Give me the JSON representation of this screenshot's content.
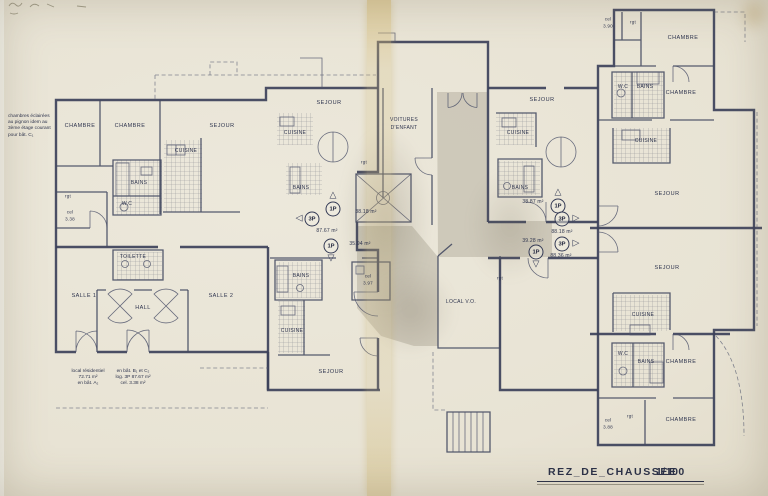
{
  "title": {
    "name": "REZ_DE_CHAUSSEE",
    "scale": "1/100"
  },
  "labels": {
    "chambre": "CHAMBRE",
    "sejour": "SEJOUR",
    "cuisine": "CUISINE",
    "bains": "BAINS",
    "wc": "W.C",
    "toilette": "TOILETTE",
    "salle1": "SALLE 1",
    "salle2": "SALLE 2",
    "hall": "HALL",
    "voitures1": "VOITURES",
    "voitures2": "D'ENFANT",
    "local_vo": "LOCAL V.O.",
    "rgt": "rgt",
    "cel": "cel"
  },
  "cells": {
    "left": "3.38",
    "center": "3.97",
    "top_right": "3.90",
    "bottom_right": "3.88"
  },
  "arrows": {
    "up": "△",
    "down": "▽",
    "left": "◁",
    "right": "▷"
  },
  "units": [
    {
      "type": "1P",
      "area": "38.18 m²"
    },
    {
      "type": "3P",
      "area": "87.67 m²"
    },
    {
      "type": "1P",
      "area": "35.94 m²"
    },
    {
      "type": "1P",
      "area": "38.87 m²"
    },
    {
      "type": "3P",
      "area": "88.18 m²"
    },
    {
      "type": "3P",
      "area": "88.36 m²"
    },
    {
      "type": "1P",
      "area": "39.28 m²"
    }
  ],
  "notes": {
    "margin": [
      "chambres éclairées",
      "au pignon idem au",
      "3ème étage courant",
      "pour bât. C₁"
    ],
    "residential": [
      "local résidentiel",
      "72.71 m²",
      "en bât. A₂"
    ],
    "variant": [
      "en bât. B₁ et C₂",
      "log. 3P  87.67 m²",
      "cel. 3.38 m²"
    ]
  }
}
